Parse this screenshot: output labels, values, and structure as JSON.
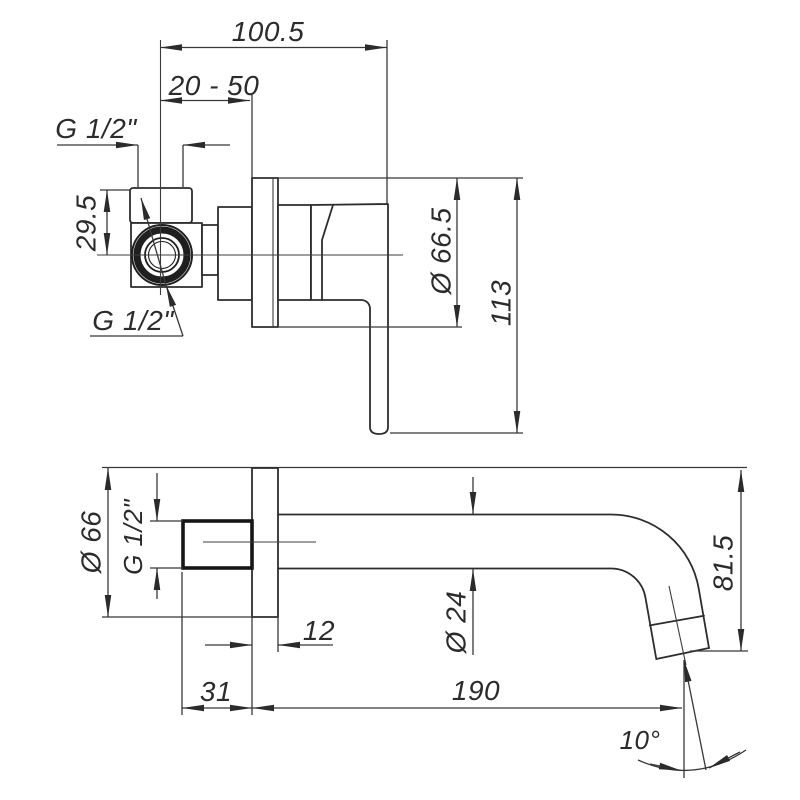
{
  "page": {
    "background": "#ffffff",
    "line_color": "#2d2d2d",
    "drawing_type": "technical-dimension-drawing"
  },
  "drawing": {
    "views": {
      "mixer_side_view": {
        "dims": {
          "total_projection": "100.5",
          "depth_range": "20 - 50",
          "thread_top": "G 1/2\"",
          "vertical_offset": "29.5",
          "thread_front": "G 1/2\"",
          "plate_diameter": "Ø 66.5",
          "total_height": "113"
        }
      },
      "spout_side_view": {
        "dims": {
          "flange_diameter": "Ø 66",
          "thread_inlet": "G 1/2\"",
          "flange_thickness": "12",
          "wall_depth": "31",
          "spout_reach": "190",
          "spout_diameter": "Ø 24",
          "spout_height": "81.5",
          "stream_angle": "10°"
        }
      }
    }
  }
}
